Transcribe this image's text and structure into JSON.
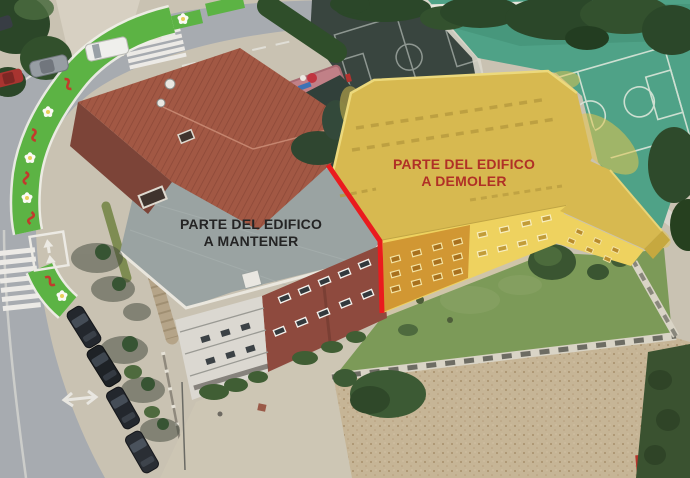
{
  "annotations": {
    "keep_label": {
      "line1": "PARTE DEL EDIFICO",
      "line2": "A MANTENER",
      "color": "#242424"
    },
    "demolish_label": {
      "line1": "PARTE DEL EDIFICO",
      "line2": "A DEMOLER",
      "color": "#b03026"
    }
  },
  "markup": {
    "division_line_color": "#ea1b1e",
    "highlight_roof_color": "#d7b950",
    "highlight_facade_color": "#eed25f",
    "highlight_facade_tint_color": "#d19733"
  }
}
